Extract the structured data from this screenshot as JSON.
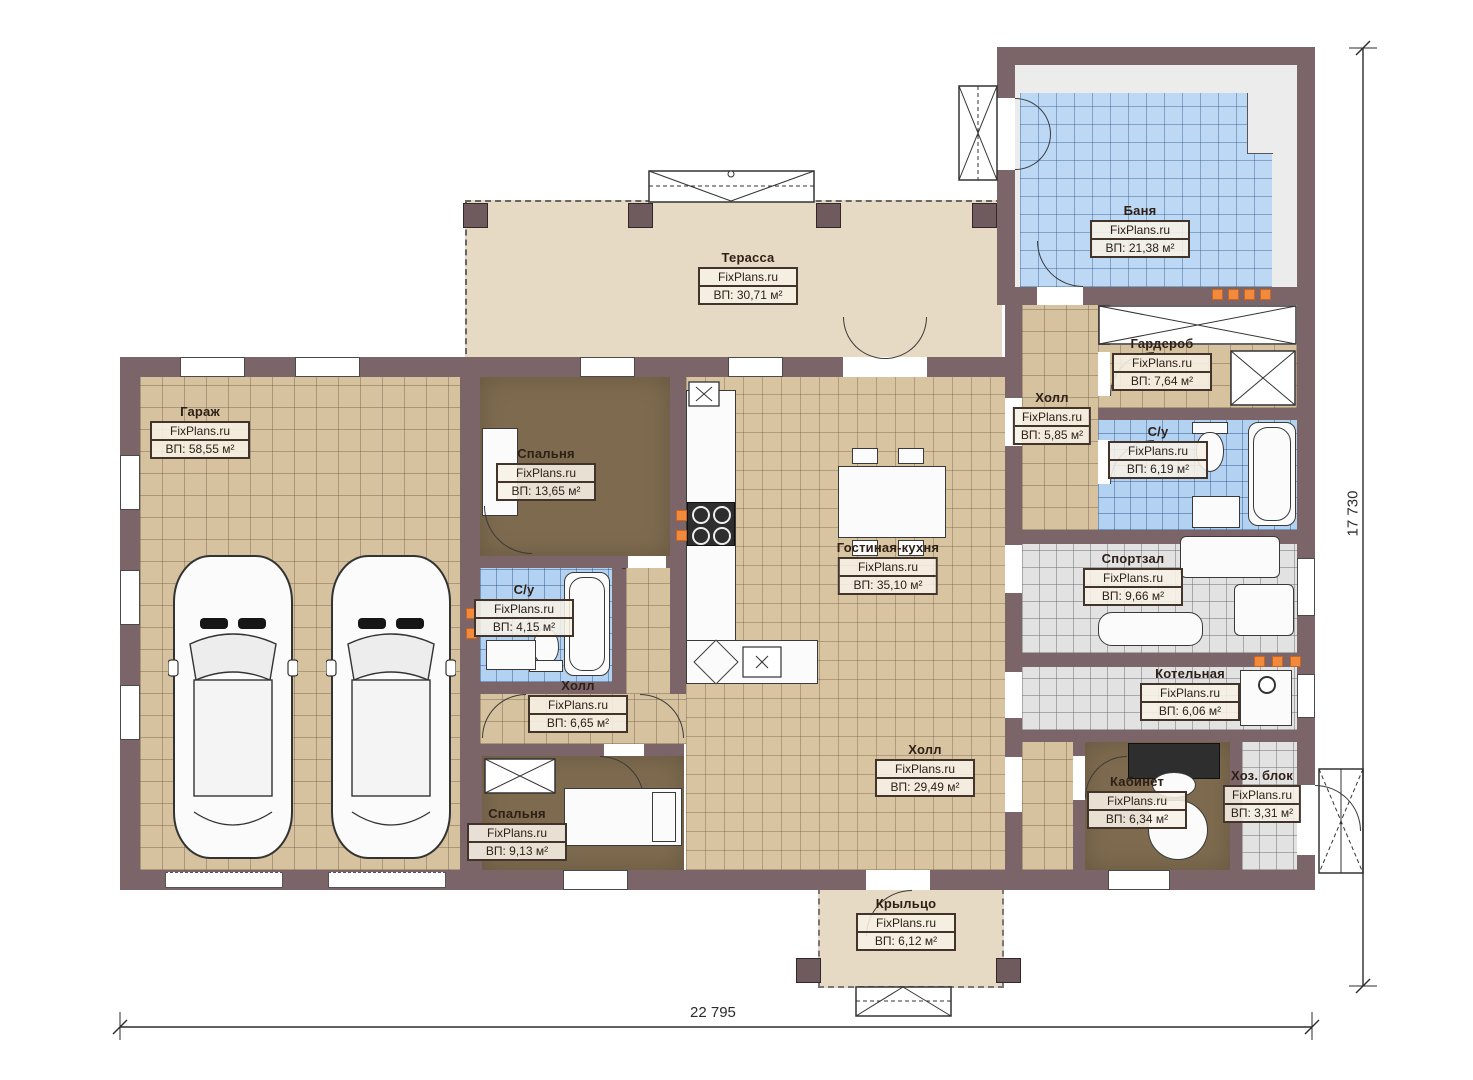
{
  "plan": {
    "watermark": "FixPlans.ru",
    "dim_width": "22 795",
    "dim_height": "17 730"
  },
  "rooms": {
    "garage": {
      "name": "Гараж",
      "area": "ВП: 58,55 м²"
    },
    "bedroom_top": {
      "name": "Спальня",
      "area": "ВП: 13,65 м²"
    },
    "terrace": {
      "name": "Терасса",
      "area": "ВП: 30,71 м²"
    },
    "banya": {
      "name": "Баня",
      "area": "ВП: 21,38 м²"
    },
    "wardrobe": {
      "name": "Гардероб",
      "area": "ВП: 7,64 м²"
    },
    "hall_right": {
      "name": "Холл",
      "area": "ВП: 5,85 м²"
    },
    "wc_right": {
      "name": "С/у",
      "area": "ВП: 6,19 м²"
    },
    "living_kitchen": {
      "name": "Гостиная-кухня",
      "area": "ВП: 35,10 м²"
    },
    "gym": {
      "name": "Спортзал",
      "area": "ВП: 9,66 м²"
    },
    "wc_left": {
      "name": "С/у",
      "area": "ВП: 4,15 м²"
    },
    "hall_left": {
      "name": "Холл",
      "area": "ВП: 6,65 м²"
    },
    "bedroom_bottom": {
      "name": "Спальня",
      "area": "ВП: 9,13 м²"
    },
    "boiler": {
      "name": "Котельная",
      "area": "ВП: 6,06 м²"
    },
    "hall_main": {
      "name": "Холл",
      "area": "ВП: 29,49 м²"
    },
    "office": {
      "name": "Кабинет",
      "area": "ВП: 6,34 м²"
    },
    "utility": {
      "name": "Хоз. блок",
      "area": "ВП: 3,31 м²"
    },
    "porch": {
      "name": "Крыльцо",
      "area": "ВП: 6,12 м²"
    }
  },
  "colors": {
    "wall": "#7b6569",
    "floor_tan": "#d6c29e",
    "floor_blue": "#b3d2f2",
    "floor_grey": "#e2e2e2",
    "floor_brown": "#7e6b4f",
    "terrace_beige": "#e7dac4",
    "accent_orange": "#f28a3d",
    "line": "#3a3a3a"
  }
}
